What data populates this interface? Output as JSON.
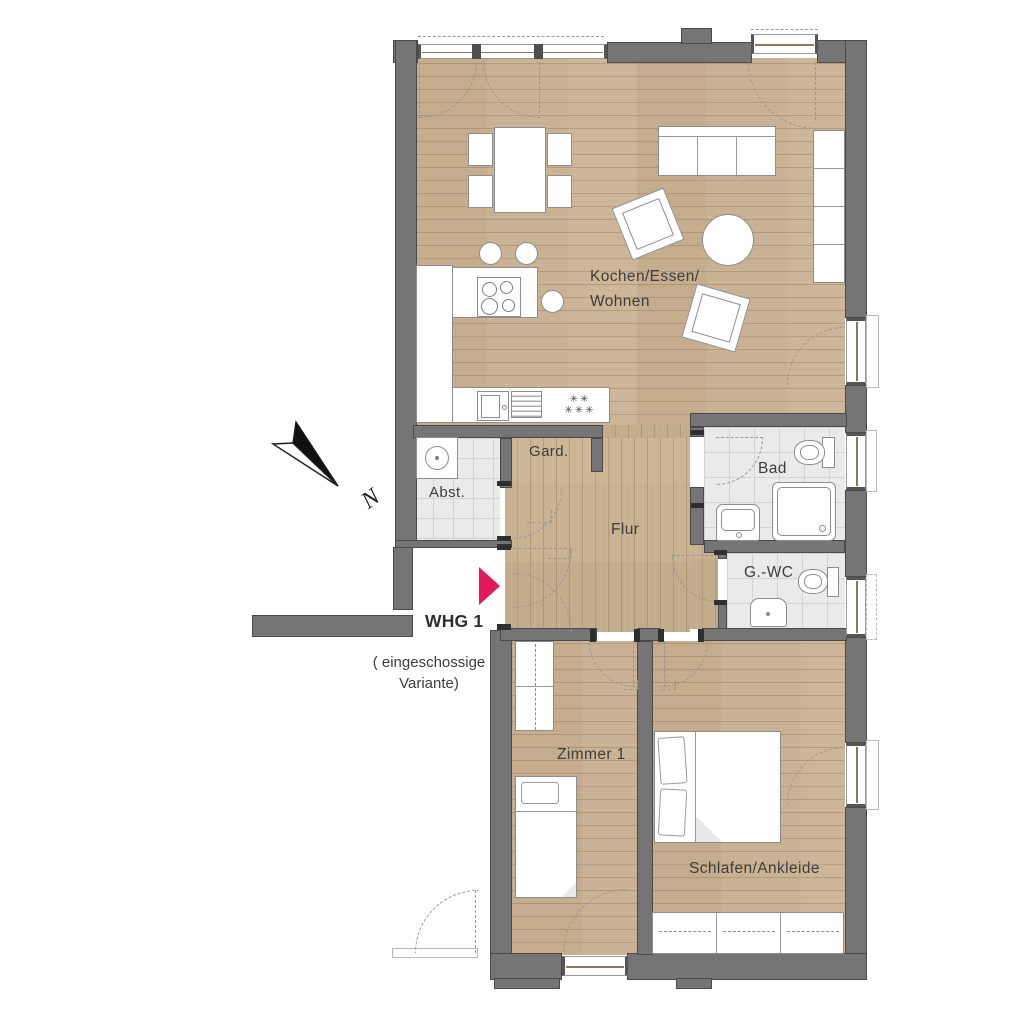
{
  "plan": {
    "unit_label": "WHG 1",
    "unit_note_line1": "( eingeschossige",
    "unit_note_line2": "Variante)"
  },
  "compass": {
    "label": "N"
  },
  "rooms": {
    "living": {
      "label_line1": "Kochen/Essen/",
      "label_line2": "Wohnen"
    },
    "gard": {
      "label": "Gard."
    },
    "abst": {
      "label": "Abst."
    },
    "flur": {
      "label": "Flur"
    },
    "bad": {
      "label": "Bad"
    },
    "gwc": {
      "label": "G.-WC"
    },
    "zimmer1": {
      "label": "Zimmer 1"
    },
    "schlafen": {
      "label": "Schlafen/Ankleide"
    }
  },
  "kitchen": {
    "freezer_symbols_row1": "✳✳",
    "freezer_symbols_row2": "✳✳✳"
  },
  "colors": {
    "wall": "#757575",
    "wall_outline": "#4a4a4a",
    "wood": "#c9b293",
    "tile": "#e9ebeb",
    "accent": "#e3185c",
    "dash": "#979797",
    "text": "#3d3d3d"
  }
}
